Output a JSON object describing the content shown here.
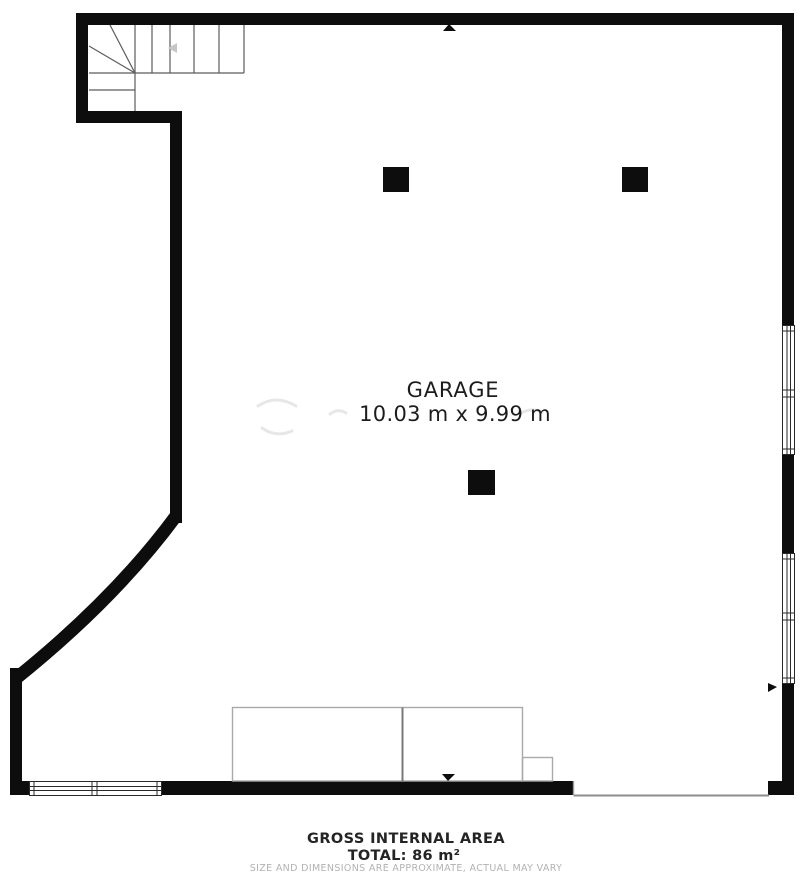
{
  "plan": {
    "room_label": "GARAGE",
    "room_dimensions": "10.03 m x 9.99 m"
  },
  "footer": {
    "title": "GROSS INTERNAL AREA",
    "total": "TOTAL: 86 m²",
    "disclaimer": "SIZE AND DIMENSIONS ARE APPROXIMATE, ACTUAL MAY VARY"
  },
  "colors": {
    "wall": "#0d0d0d",
    "thin_line": "#9c9c9c",
    "window_frame": "#2a2a2a",
    "text": "#1c1c1c",
    "muted_text": "#b2b2b2"
  }
}
